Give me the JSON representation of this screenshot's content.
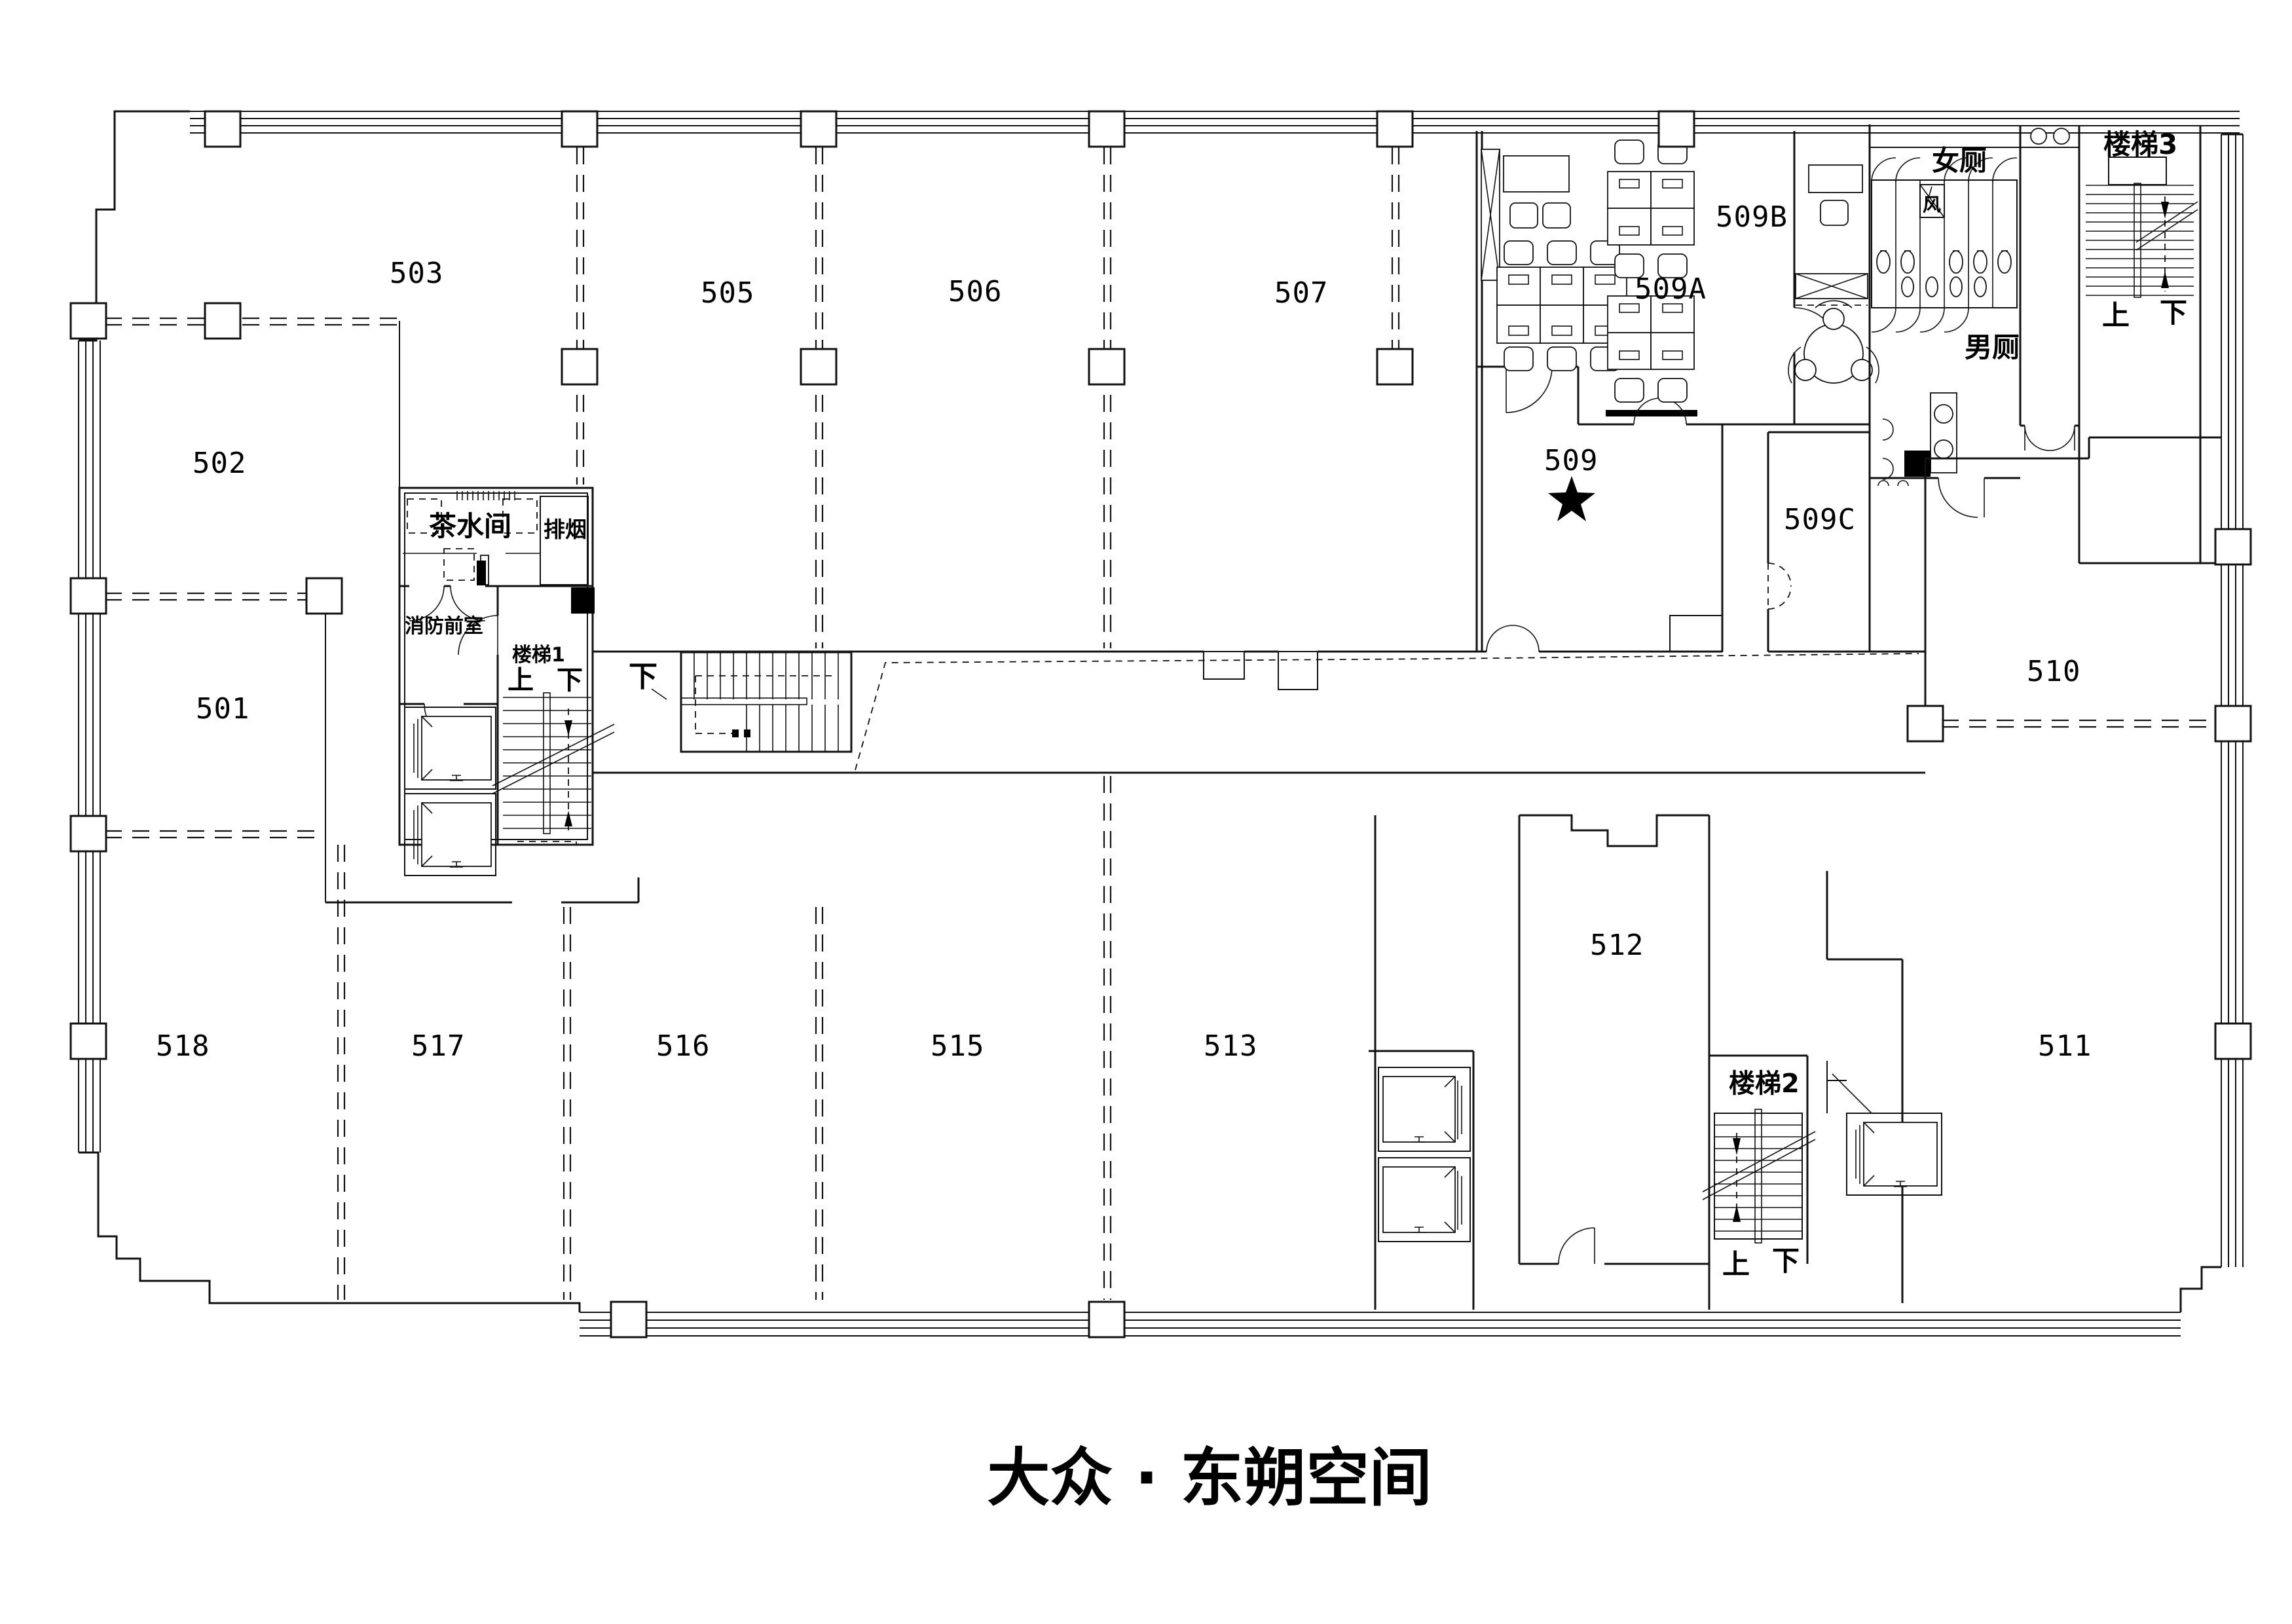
{
  "title": "大众 · 东朔空间",
  "rooms": {
    "r501": "501",
    "r502": "502",
    "r503": "503",
    "r505": "505",
    "r506": "506",
    "r507": "507",
    "r509": "509",
    "r509a": "509A",
    "r509b": "509B",
    "r509c": "509C",
    "r510": "510",
    "r511": "511",
    "r512": "512",
    "r513": "513",
    "r515": "515",
    "r516": "516",
    "r517": "517",
    "r518": "518"
  },
  "labels": {
    "tea_room": "茶水间",
    "smoke_exhaust": "排烟",
    "fire_lobby": "消防前室",
    "stair1": "楼梯1",
    "stair2": "楼梯2",
    "stair3": "楼梯3",
    "up": "上",
    "down": "下",
    "female_toilet": "女厕",
    "male_toilet": "男厕",
    "vent": "风"
  }
}
